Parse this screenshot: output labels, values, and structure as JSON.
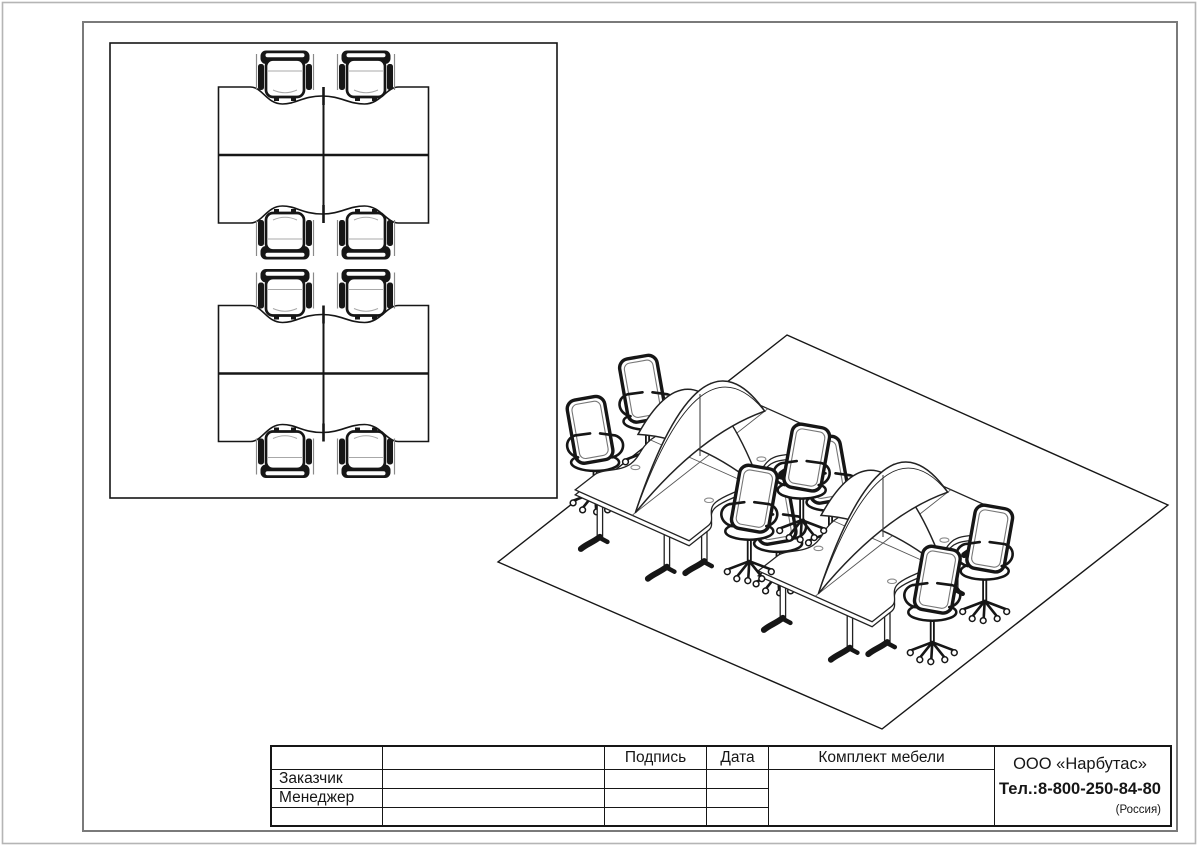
{
  "sheet": {
    "title_block": {
      "signature_label": "Подпись",
      "date_label": "Дата",
      "set_label": "Комплект мебели",
      "customer_label": "Заказчик",
      "manager_label": "Менеджер",
      "company": {
        "name": "ООО «Нарбутас»",
        "phone": "Тел.:8-800-250-84-80",
        "country": "(Россия)"
      }
    },
    "colors": {
      "background": "#ffffff",
      "line": "#161616",
      "page_border": "#7a7a7a",
      "canvas_edge": "#b5b5b5"
    }
  }
}
